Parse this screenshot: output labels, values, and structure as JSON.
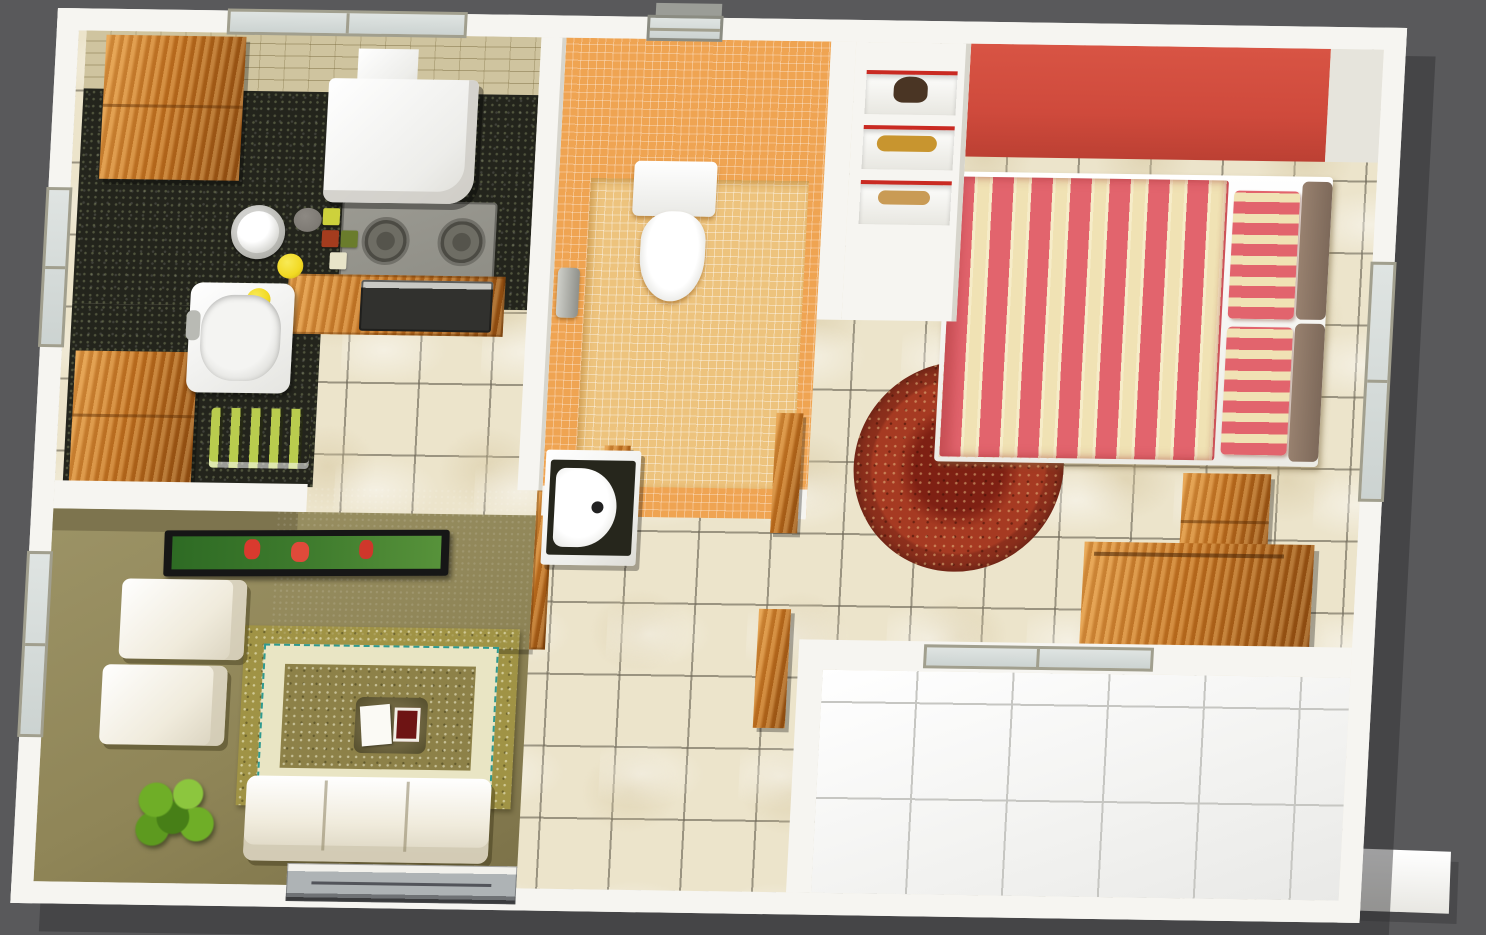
{
  "scene": {
    "type": "3d-floorplan-render",
    "view": "top-down-isometric",
    "text_visible": false,
    "rooms": [
      {
        "name": "kitchen",
        "objects": [
          "wood-cabinet",
          "wood-cabinet",
          "granite-counter",
          "backsplash",
          "window",
          "sink",
          "tap",
          "kettle",
          "lemons",
          "stone",
          "spice-jars",
          "extractor-hood",
          "gas-cooktop",
          "burner",
          "burner",
          "oven",
          "dish-rack",
          "hanging-utensils"
        ]
      },
      {
        "name": "bathroom",
        "objects": [
          "orange-mosaic-walls",
          "mosaic-floor",
          "toilet",
          "shower-mixer",
          "ventilation-window",
          "door-frame-posts",
          "vanity-black-counter",
          "half-round-sink"
        ]
      },
      {
        "name": "bedroom",
        "objects": [
          "red-accent-wall",
          "double-bed",
          "striped-duvet",
          "striped-pillow",
          "striped-pillow",
          "brown-headboard",
          "round-red-rug",
          "nightstand",
          "wood-dresser",
          "display-niche-elephant",
          "display-niche-leopard",
          "display-niche-deer",
          "window",
          "sliding-door-to-balcony"
        ]
      },
      {
        "name": "living-room",
        "objects": [
          "tv-partition-wall",
          "flat-tv-soccer-screen",
          "armchair",
          "armchair",
          "sofa-three-seat",
          "area-rug",
          "coffee-table",
          "magazine",
          "red-tray",
          "potted-plant",
          "window",
          "entry-sliding-door"
        ]
      },
      {
        "name": "hallway",
        "objects": [
          "marble-floor-tiles",
          "wood-door-post"
        ]
      },
      {
        "name": "balcony",
        "objects": [
          "white-floor-tiles",
          "exterior-plinth"
        ]
      }
    ],
    "niche_figurines": [
      "elephant",
      "leopard",
      "deer"
    ]
  },
  "palette": {
    "bg": "#59595b",
    "wall": "#f6f5f1",
    "wallShade": "#e6e4dc",
    "wallDark": "#d7d5cc",
    "floorTile": "#ece4cb",
    "balconyTile": "#f2f2f0",
    "balconyGrout": "#c6c6c2",
    "granite": "#23241c",
    "backsplash": "#cfc49f",
    "wood": "#c2711f",
    "woodDark": "#8e4c10",
    "woodLight": "#e29a44",
    "bathWall": "#efa452",
    "bathFloor": "#edc37d",
    "mosaicLine": "rgba(255,255,255,0.32)",
    "redWall": "#cf4a3c",
    "bedStripeRed": "#e2646d",
    "bedStripeCream": "#f0e2b4",
    "headboard": "#98816f",
    "rugRound": "#a63a22",
    "rugRoundDark": "#7e2013",
    "rugRoundEdge": "#8a6b3a",
    "sofa": "#f0ebdc",
    "sofaShade": "#d8d1bc",
    "oliveWall": "#9c9366",
    "oliveDark": "#7d744e",
    "livingFloor": "#8f8557",
    "rugGold": "#a09345",
    "rugBand": "#e9e5c4",
    "rugTeal": "#2f9a90",
    "rugCenter": "#8d8148",
    "tvFrame": "#161616",
    "tvField": "#3e7b2d",
    "plant": "#6fae27",
    "plantDark": "#477f17",
    "partition": "#908f8a",
    "glass": "#ccd3d1",
    "glassLight": "#dfe4e2",
    "frame": "#a19f8e",
    "cooktop": "#8e8d85",
    "burner": "#55544c",
    "oven": "#31312e",
    "steel": "#c9c9c4",
    "nicheRed": "#c92a22",
    "figElephant": "#4a3524",
    "figLeopard": "#c8952f",
    "figDeer": "#c99b55",
    "vanityTop": "#26261c",
    "lemon": "#f2d922",
    "stone": "#7e7a74",
    "greenPlate": "#b9cc4e",
    "doorGrey": "#aeb3b5",
    "track": "#6f7275"
  }
}
